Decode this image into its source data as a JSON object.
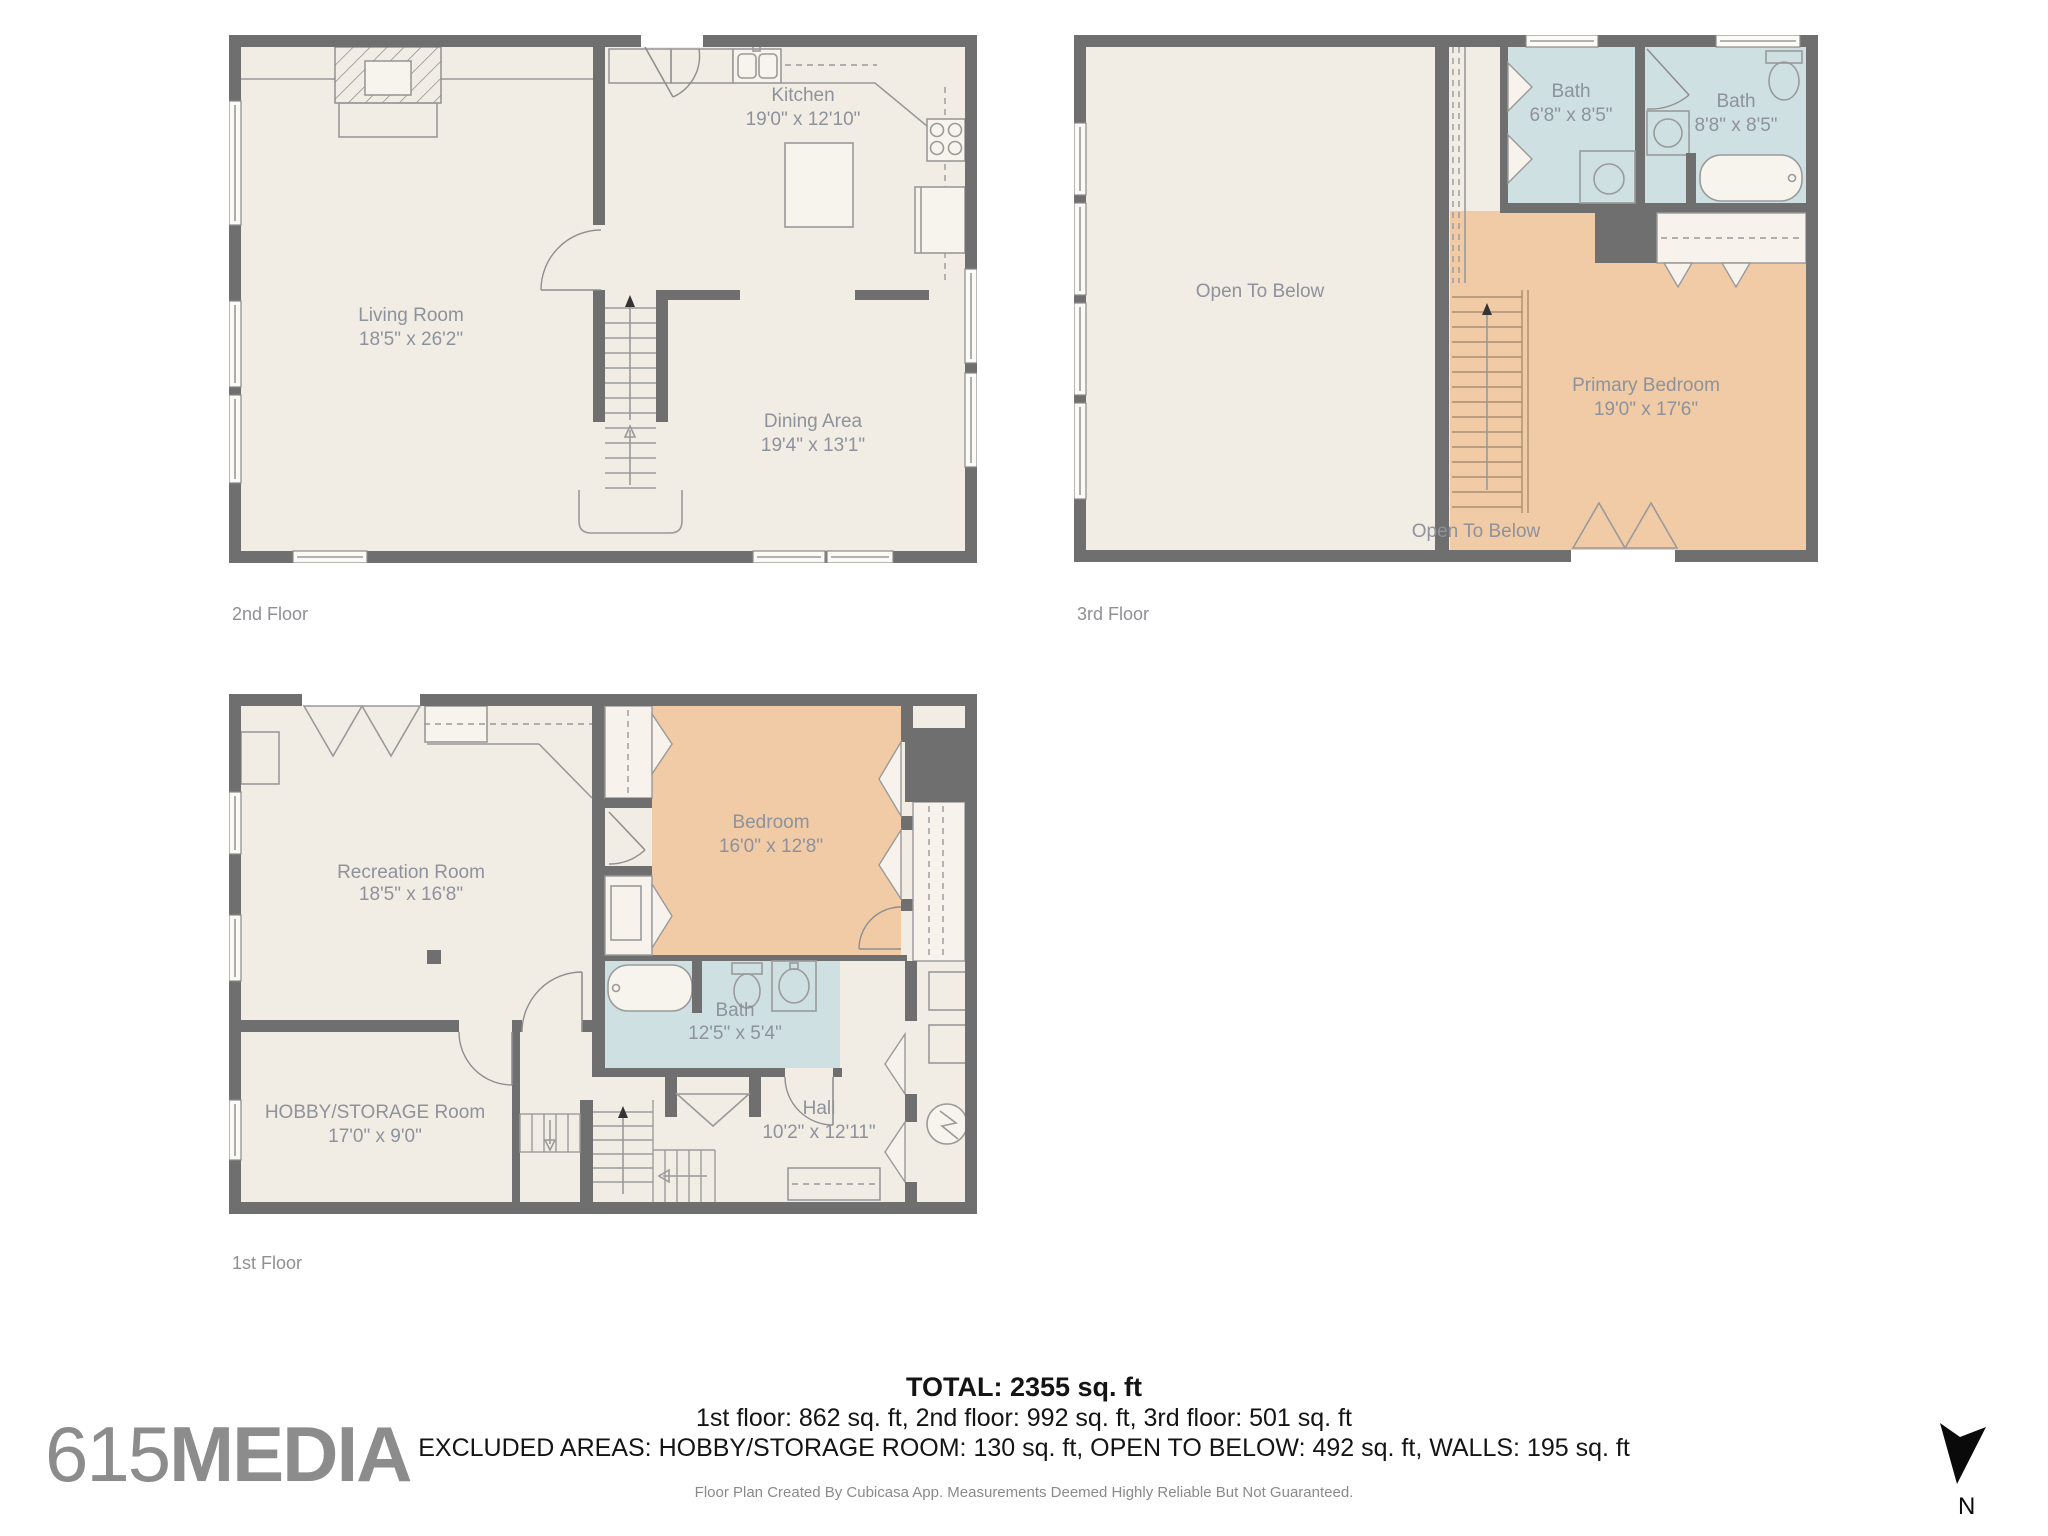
{
  "colors": {
    "wall": "#6f6f6f",
    "floor": "#f2ede4",
    "bath": "#cfe0e3",
    "bedroom": "#f0cba6",
    "label_text": "#8d929c",
    "summary_text": "#141414",
    "logo_gray": "#8c8c8c"
  },
  "floors": {
    "second": {
      "caption": "2nd Floor",
      "rooms": [
        {
          "label": "Kitchen",
          "dims": "19'0\" x 12'10\""
        },
        {
          "label": "Living Room",
          "dims": "18'5\" x 26'2\""
        },
        {
          "label": "Dining Area",
          "dims": "19'4\" x 13'1\""
        }
      ]
    },
    "third": {
      "caption": "3rd Floor",
      "rooms": [
        {
          "label": "Bath",
          "dims": "6'8\" x 8'5\""
        },
        {
          "label": "Bath",
          "dims": "8'8\" x 8'5\""
        },
        {
          "label": "Open To Below",
          "dims": ""
        },
        {
          "label": "Primary Bedroom",
          "dims": "19'0\" x 17'6\""
        },
        {
          "label": "Open To Below",
          "dims": ""
        }
      ]
    },
    "first": {
      "caption": "1st Floor",
      "rooms": [
        {
          "label": "Recreation Room",
          "dims": "18'5\" x 16'8\""
        },
        {
          "label": "Bedroom",
          "dims": "16'0\" x 12'8\""
        },
        {
          "label": "HOBBY/STORAGE Room",
          "dims": "17'0\" x 9'0\""
        },
        {
          "label": "Bath",
          "dims": "12'5\" x 5'4\""
        },
        {
          "label": "Hall",
          "dims": "10'2\" x 12'11\""
        }
      ]
    }
  },
  "summary": {
    "total": "TOTAL: 2355 sq. ft",
    "floors_line": "1st floor: 862 sq. ft, 2nd floor: 992 sq. ft, 3rd floor: 501 sq. ft",
    "excluded_line": "EXCLUDED AREAS: HOBBY/STORAGE ROOM: 130 sq. ft, OPEN TO BELOW: 492 sq. ft, WALLS: 195 sq. ft"
  },
  "branding": {
    "logo_thin": "615",
    "logo_bold": "MEDIA"
  },
  "footer": {
    "disclaimer": "Floor Plan Created By Cubicasa App. Measurements Deemed Highly Reliable But Not Guaranteed."
  },
  "compass": {
    "label": "N"
  }
}
